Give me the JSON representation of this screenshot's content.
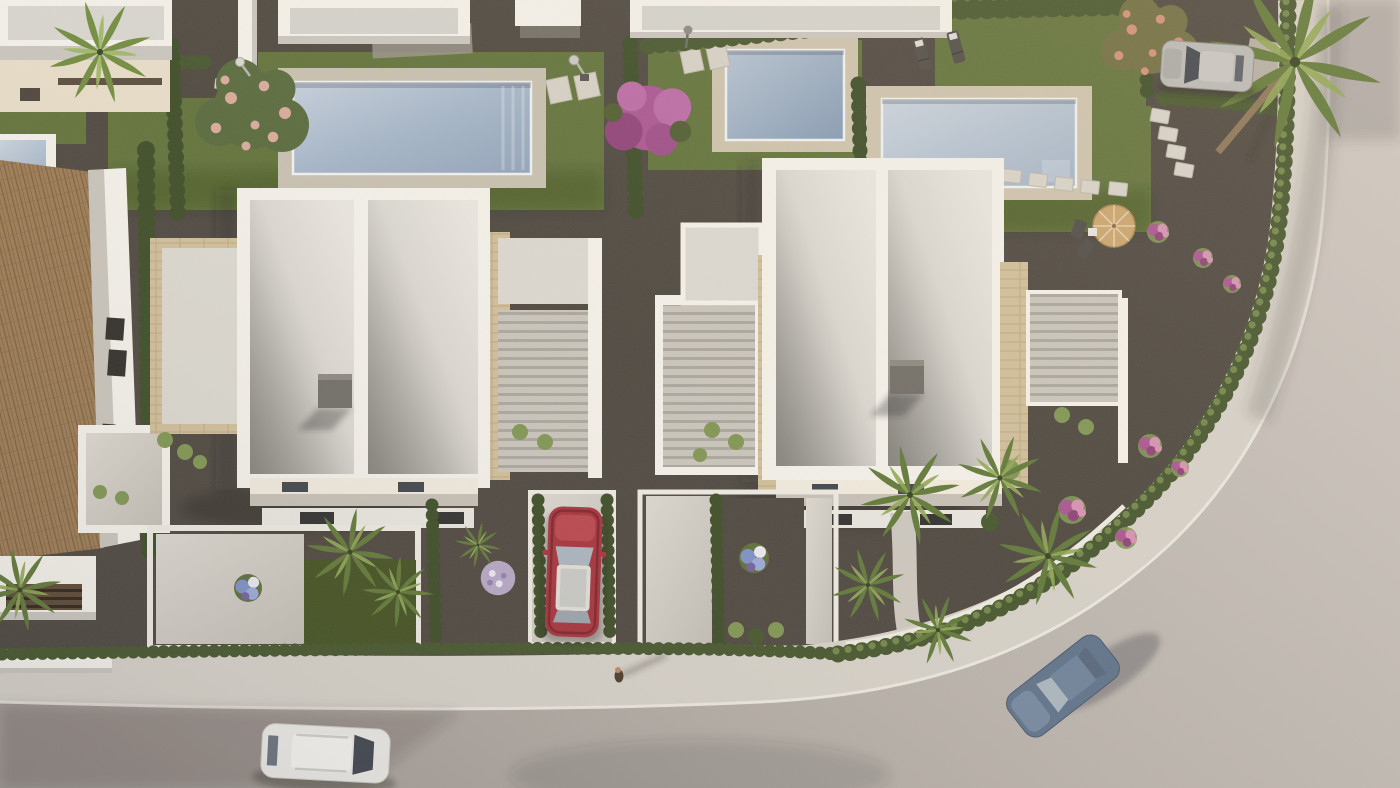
{
  "scene": {
    "type": "aerial-3d-architectural-render",
    "description": "Bird's-eye 3D rendering of a modern residential development: two white two-storey villas with gravel flat roofs and travertine side terraces, private swimming pools with sun decks, landscaped gardens with cypress hedges, fan palms and flowering shrubs, a tiled-roof house at the left, neighbouring white buildings at the top, and a curving light asphalt road with sidewalk, parked and moving cars and a pedestrian, in warm late-afternoon light",
    "objects": [
      "modern-white-villa-left",
      "modern-white-villa-right",
      "neighbour-buildings-top",
      "tiled-roof-house-left",
      "swimming-pool-lot1",
      "swimming-pool-lot2",
      "swimming-pool-lot3",
      "partial-pool-left-edge",
      "curved-road",
      "sidewalk-with-curb",
      "white-car-on-road",
      "red-car-in-driveway",
      "blue-car-driving",
      "silver-suv-parked",
      "pedestrian-walking",
      "cypress-hedges",
      "fan-palms",
      "tall-palm-tree",
      "bougainvillea",
      "blossom-trees",
      "pink-flower-bushes",
      "blue-hydrangeas",
      "flower-ball-shrub",
      "sun-loungers",
      "garden-parasol-with-chairs",
      "stepping-stone-paths",
      "outdoor-showers",
      "garden-lamp",
      "roof-chimneys",
      "pergola-terraces",
      "front-garden-walls"
    ],
    "lighting": "low warm sun, long soft shadows",
    "camera": "top-down aerial, slight oblique"
  },
  "palette": {
    "gravel": "#4b453d",
    "gravel-light": "#9a938a",
    "lawn": "#5f7038",
    "lawn-dark": "#42501f",
    "hedge": "#44542b",
    "hedge-light": "#7e9450",
    "cypress": "#3a4a24",
    "palm": "#5f7736",
    "palm-light": "#8fa652",
    "road": "#b2aaa3",
    "road-light": "#cbc5bf",
    "sidewalk": "#d5d0c7",
    "curb": "#eae6de",
    "wall-white": "#f3f0e9",
    "wall-shade": "#c8c4bd",
    "wall-cream": "#e6dcc6",
    "roof-panel": "#d9d6cf",
    "roof-shade": "#a9a69f",
    "pool-water": "#9db0c4",
    "pool-water-light": "#c4cedb",
    "pool-deck": "#ccc2ab",
    "pool-deck-gray": "#c6bfae",
    "stone": "#cfbd98",
    "stone-dark": "#b29d76",
    "tile-roof": "#9b7a52",
    "tile-dark": "#74573a",
    "slab": "#d2cdc4",
    "slat": "#c8c3ba",
    "slat-gap": "#a9a59d",
    "pergola-wood": "#53402e",
    "chimney": "#6f6c65",
    "glass": "#3e434b",
    "glass-light": "#a9b4bd",
    "car-red": "#a53039",
    "car-blue": "#5e7188",
    "car-white": "#eae9e4",
    "car-silver": "#b9b9b5",
    "flower-magenta": "#a8538f",
    "flower-pink": "#d490b0",
    "flower-blue": "#7b8fc4",
    "flower-white": "#e9e7ef",
    "blossom": "#d5a290",
    "parasol": "#c9a36b",
    "person-skin": "#b98a63",
    "person-dark": "#4a3828"
  }
}
